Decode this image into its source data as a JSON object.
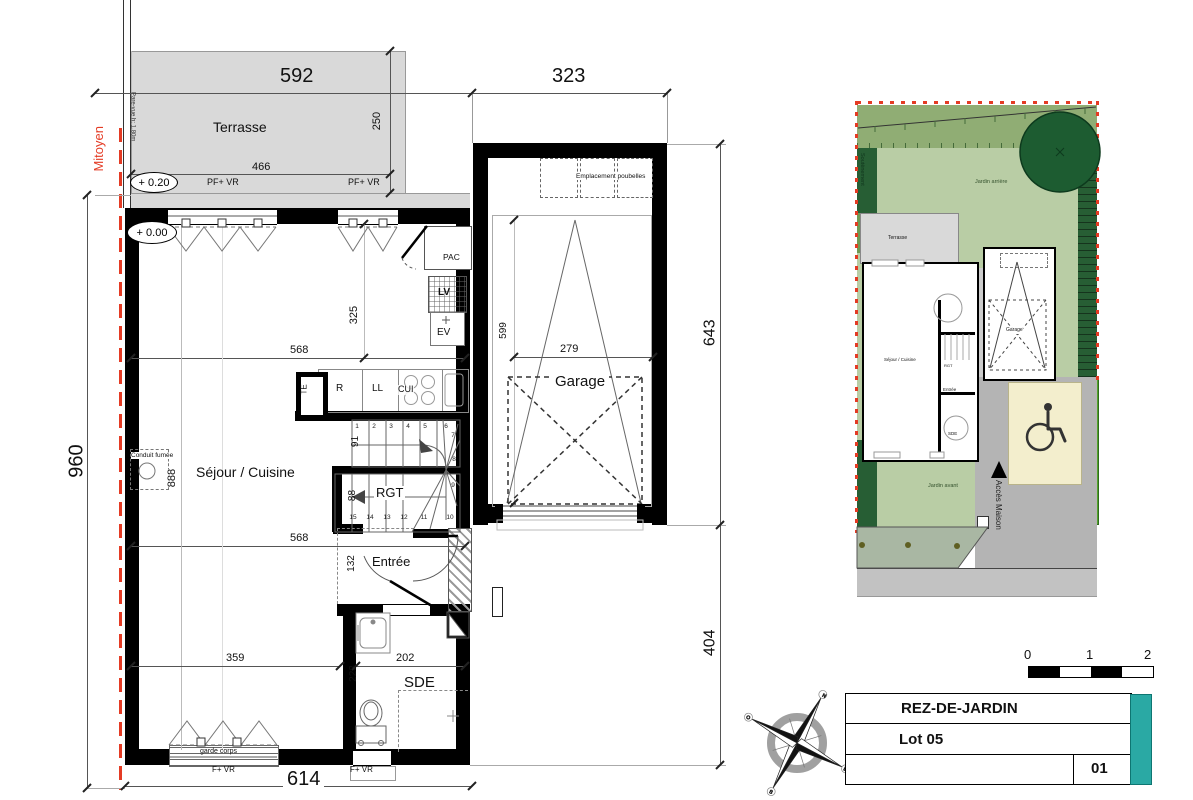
{
  "floorplan": {
    "rooms": {
      "terrasse": "Terrasse",
      "sejour": "Séjour / Cuisine",
      "garage": "Garage",
      "entree": "Entrée",
      "sde": "SDE",
      "rgt": "RGT"
    },
    "fixtures": {
      "pac": "PAC",
      "lv": "LV",
      "ev": "EV",
      "te": "TE",
      "r": "R",
      "ll": "LL",
      "cui": "CUI",
      "conduit": "Conduit fumée",
      "poubelles": "Emplacement poubelles"
    },
    "levels": {
      "terrace": "+ 0.20",
      "ground": "+ 0.00"
    },
    "windows": {
      "pf_vr": "PF+ VR",
      "f_vr": "F+ VR",
      "garde_corps": "garde corps"
    },
    "boundary": {
      "mitoyen": "Mitoyen",
      "pare_vue": "Pare-vue h: 1.80m"
    },
    "dims": {
      "d592": "592",
      "d323": "323",
      "d250": "250",
      "d466": "466",
      "d960": "960",
      "d643": "643",
      "d404": "404",
      "d614": "614",
      "d568": "568",
      "d325": "325",
      "d888": "888",
      "d91": "91",
      "d88": "88",
      "d599": "599",
      "d279": "279",
      "d132": "132",
      "d202": "202",
      "d223": "223",
      "d359": "359"
    },
    "stairs": [
      "1",
      "2",
      "3",
      "4",
      "5",
      "6",
      "7",
      "8",
      "9",
      "10",
      "11",
      "12",
      "13",
      "14",
      "15"
    ]
  },
  "siteplan": {
    "labels": {
      "jardin_arriere": "Jardin arrière",
      "jardin_avant": "Jardin avant",
      "terrasse": "Terrasse",
      "sejour": "Séjour / Cuisine",
      "entree": "Entrée",
      "sde": "SDE",
      "rgt": "RGT",
      "garage": "Garage",
      "acces": "Accès Maison",
      "soutenement": "Soutènement"
    },
    "colors": {
      "garden_light": "#b9cda5",
      "garden_band": "#90ad74",
      "hedge_dark": "#275e34",
      "grass_bright": "#54a32c",
      "parking_cream": "#f3eecd",
      "asphalt": "#b4b4b4",
      "sidewalk": "#a9b7a3",
      "street": "#c2c2c2",
      "boundary_red": "#e43b24"
    }
  },
  "compass": {
    "n": "N",
    "e": "E",
    "s": "S",
    "o": "O"
  },
  "scalebar": {
    "t0": "0",
    "t1": "1",
    "t2": "2"
  },
  "titleblock": {
    "level": "REZ-DE-JARDIN",
    "lot": "Lot 05",
    "sheet": "01",
    "teal": "#2aa9a4"
  }
}
